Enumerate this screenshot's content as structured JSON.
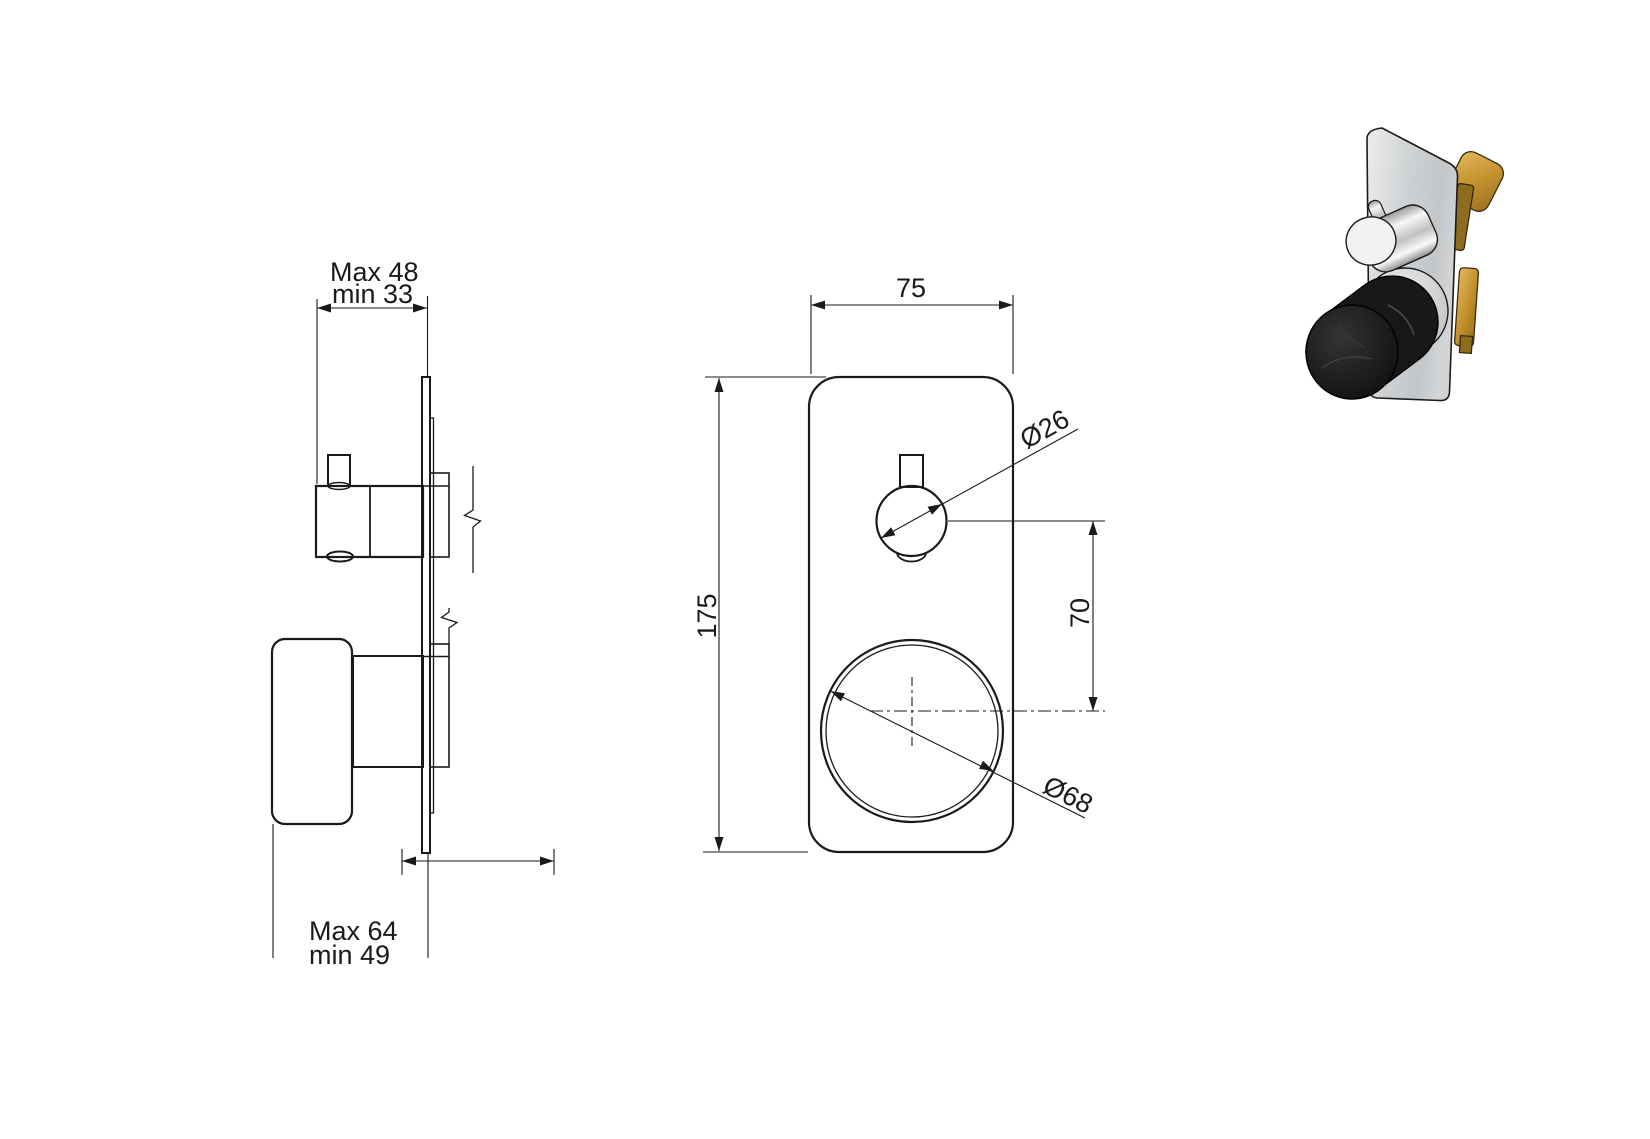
{
  "page": {
    "background": "#ffffff",
    "description": "Technical installation drawing of a concealed thermostatic shower mixer with two knobs, side view, front view and 3D product photo"
  },
  "drawing": {
    "line_color": "#1a1a1a",
    "side_view": {
      "dim_top": {
        "max": "Max 48",
        "min": "min 33"
      },
      "dim_bottom": {
        "max": "Max 64",
        "min": "min 49"
      }
    },
    "front_view": {
      "dim_plate_width": "75",
      "dim_plate_height": "175",
      "dim_small_knob_diameter": "Ø26",
      "dim_center_distance": "70",
      "dim_large_knob_diameter": "Ø68"
    }
  },
  "product_photo": {
    "colors": {
      "plate": "#ced1d3",
      "brass": "#c4922f",
      "brass_dark": "#8d6c1e",
      "chrome_light": "#f2f2f2",
      "chrome_dark": "#8f9092",
      "knob_black": "#131313"
    }
  }
}
